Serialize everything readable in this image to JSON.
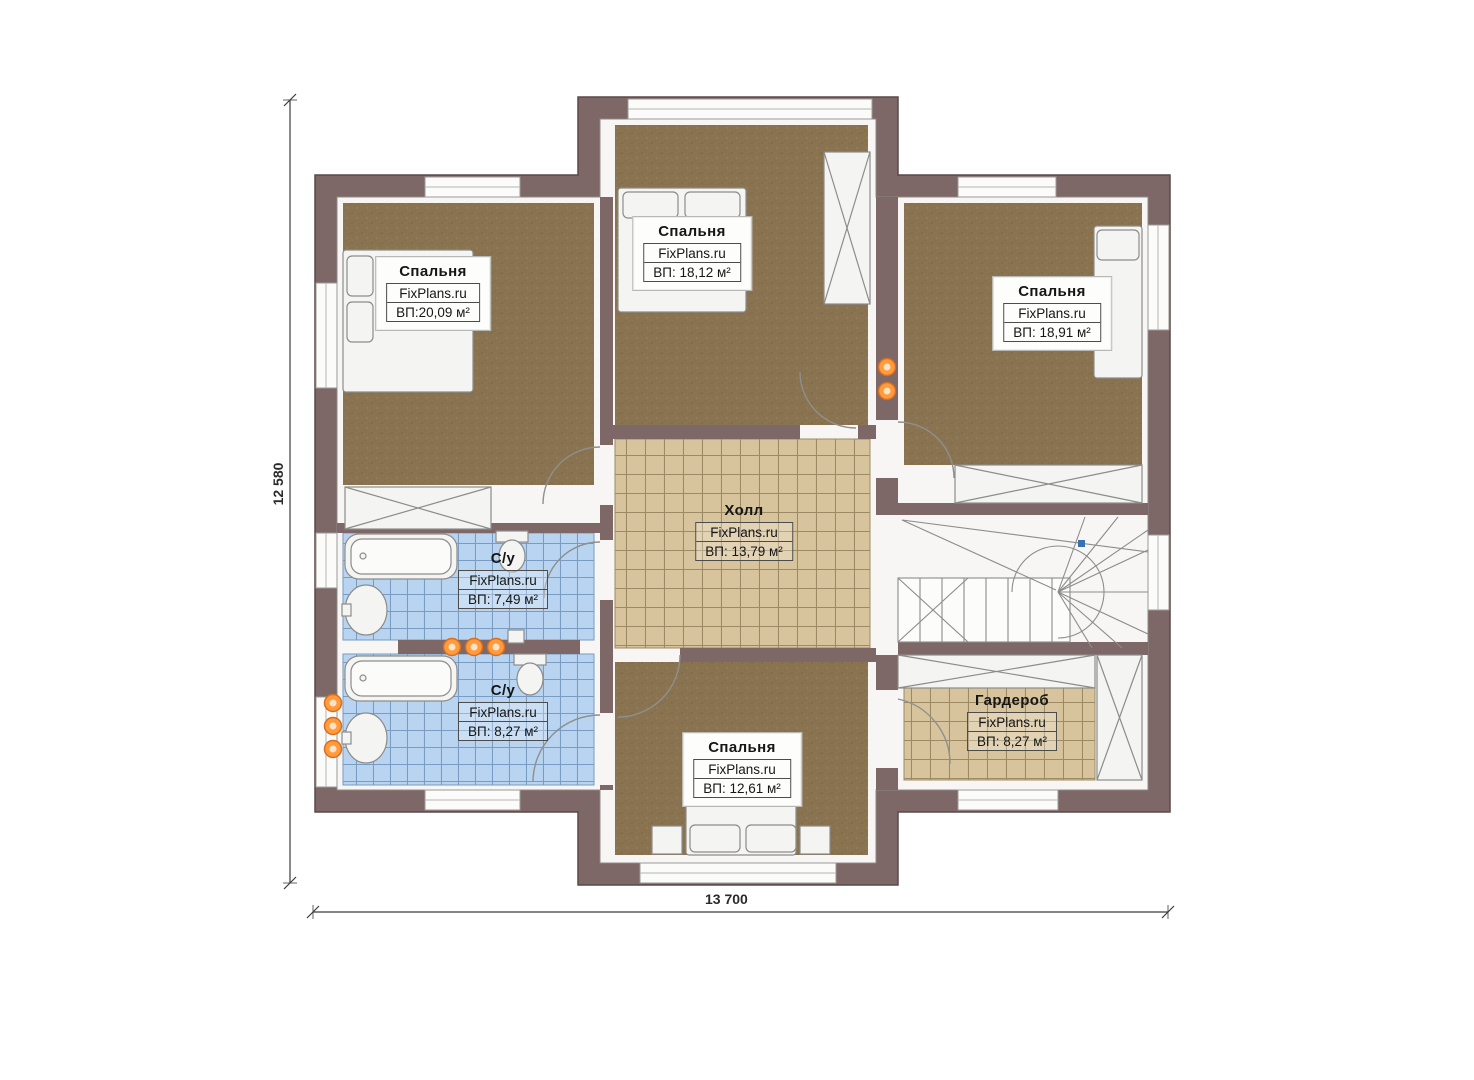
{
  "plan_title": "floor-plan-second-storey",
  "brand_watermark": "FixPlans.ru",
  "dimensions": {
    "overall_width_mm": "13 700",
    "overall_height_mm": "12 580"
  },
  "rooms": [
    {
      "id": "bedroom-top-left",
      "name": "Спальня",
      "brand": "FixPlans.ru",
      "area": "ВП:20,09 м²"
    },
    {
      "id": "bedroom-top-middle",
      "name": "Спальня",
      "brand": "FixPlans.ru",
      "area": "ВП: 18,12 м²"
    },
    {
      "id": "bedroom-top-right",
      "name": "Спальня",
      "brand": "FixPlans.ru",
      "area": "ВП: 18,91 м²"
    },
    {
      "id": "hall",
      "name": "Холл",
      "brand": "FixPlans.ru",
      "area": "ВП: 13,79 м²"
    },
    {
      "id": "bathroom-1",
      "name": "С/у",
      "brand": "FixPlans.ru",
      "area": "ВП: 7,49 м²"
    },
    {
      "id": "bathroom-2",
      "name": "С/у",
      "brand": "FixPlans.ru",
      "area": "ВП: 8,27 м²"
    },
    {
      "id": "wardrobe",
      "name": "Гардероб",
      "brand": "FixPlans.ru",
      "area": "ВП: 8,27 м²"
    },
    {
      "id": "bedroom-bottom",
      "name": "Спальня",
      "brand": "FixPlans.ru",
      "area": "ВП: 12,61 м²"
    }
  ],
  "colors": {
    "wall": "#7d6767",
    "wall_edge": "#5c4949",
    "bedroom_floor": "#8a7350",
    "hall_floor": "#d8c49c",
    "bath_floor": "#b8d4f0",
    "accent_dot": "#ff9a3d",
    "stair_marker": "#3a6fb0"
  }
}
